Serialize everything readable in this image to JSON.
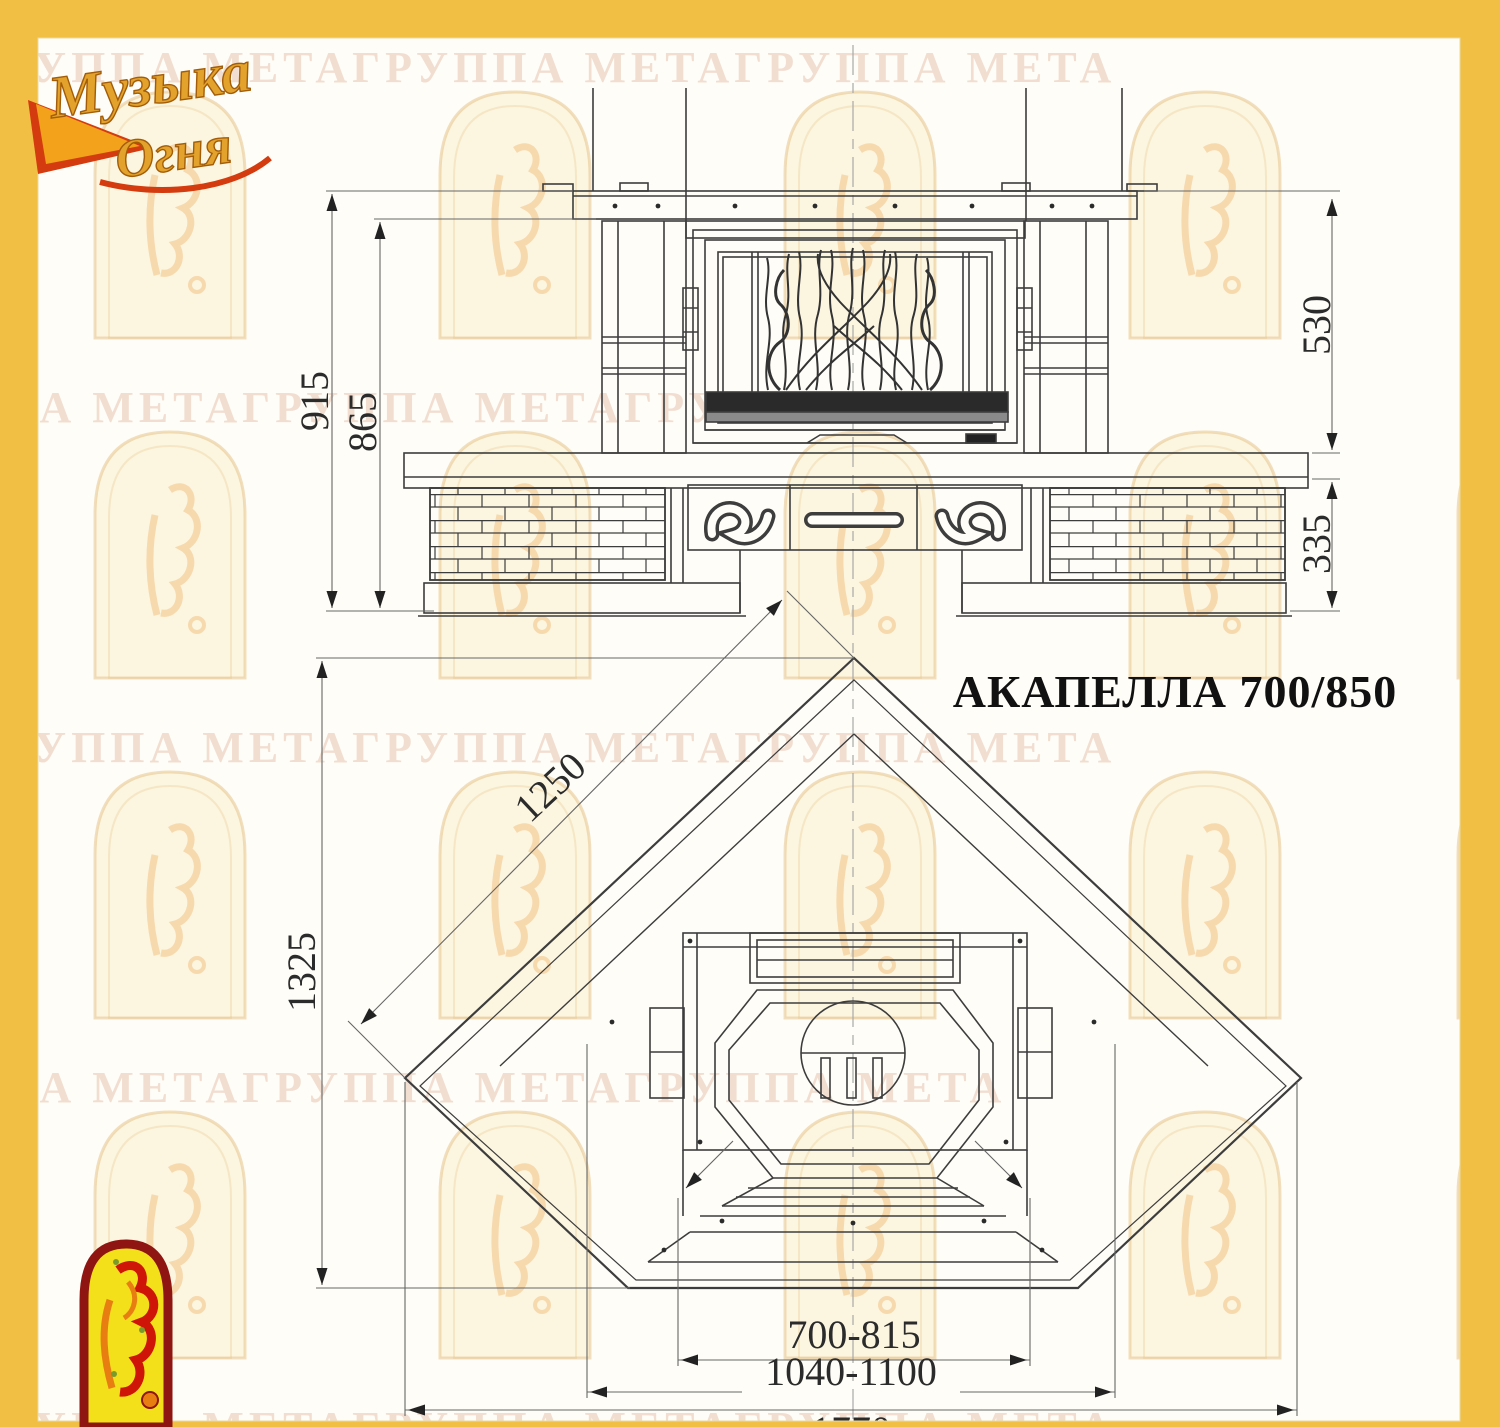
{
  "title": "АКАПЕЛЛА 700/850",
  "brand": {
    "logo_line1": "Музыка",
    "logo_line2": "Огня",
    "logo_icon": "music-of-fire-logo",
    "arch_icon": "meta-arch-logo"
  },
  "watermark": {
    "text": "ГРУППА МЕТАГРУППА МЕТАГРУППА МЕТА"
  },
  "colors": {
    "frame": "#f2bf45",
    "paper": "#fffdf7",
    "line": "#3d3d3d",
    "dim_line": "#666666",
    "dim_text": "#2b2b2b",
    "logo_gold": "#e2a22b",
    "logo_red": "#d43b0e",
    "arch_fill": "#f3e01a",
    "arch_border": "#8e1511"
  },
  "front_view": {
    "dims": [
      {
        "id": "overall-height",
        "label": "915"
      },
      {
        "id": "height-under-shelf",
        "label": "865"
      },
      {
        "id": "upper-section-height",
        "label": "530"
      },
      {
        "id": "base-section-height",
        "label": "335"
      }
    ]
  },
  "plan_view": {
    "dims": [
      {
        "id": "side-edge-length",
        "label": "1250"
      },
      {
        "id": "overall-depth",
        "label": "1325"
      },
      {
        "id": "opening-width-range",
        "label": "700-815"
      },
      {
        "id": "inner-width-range",
        "label": "1040-1100"
      },
      {
        "id": "overall-width",
        "label": "1770"
      }
    ]
  }
}
